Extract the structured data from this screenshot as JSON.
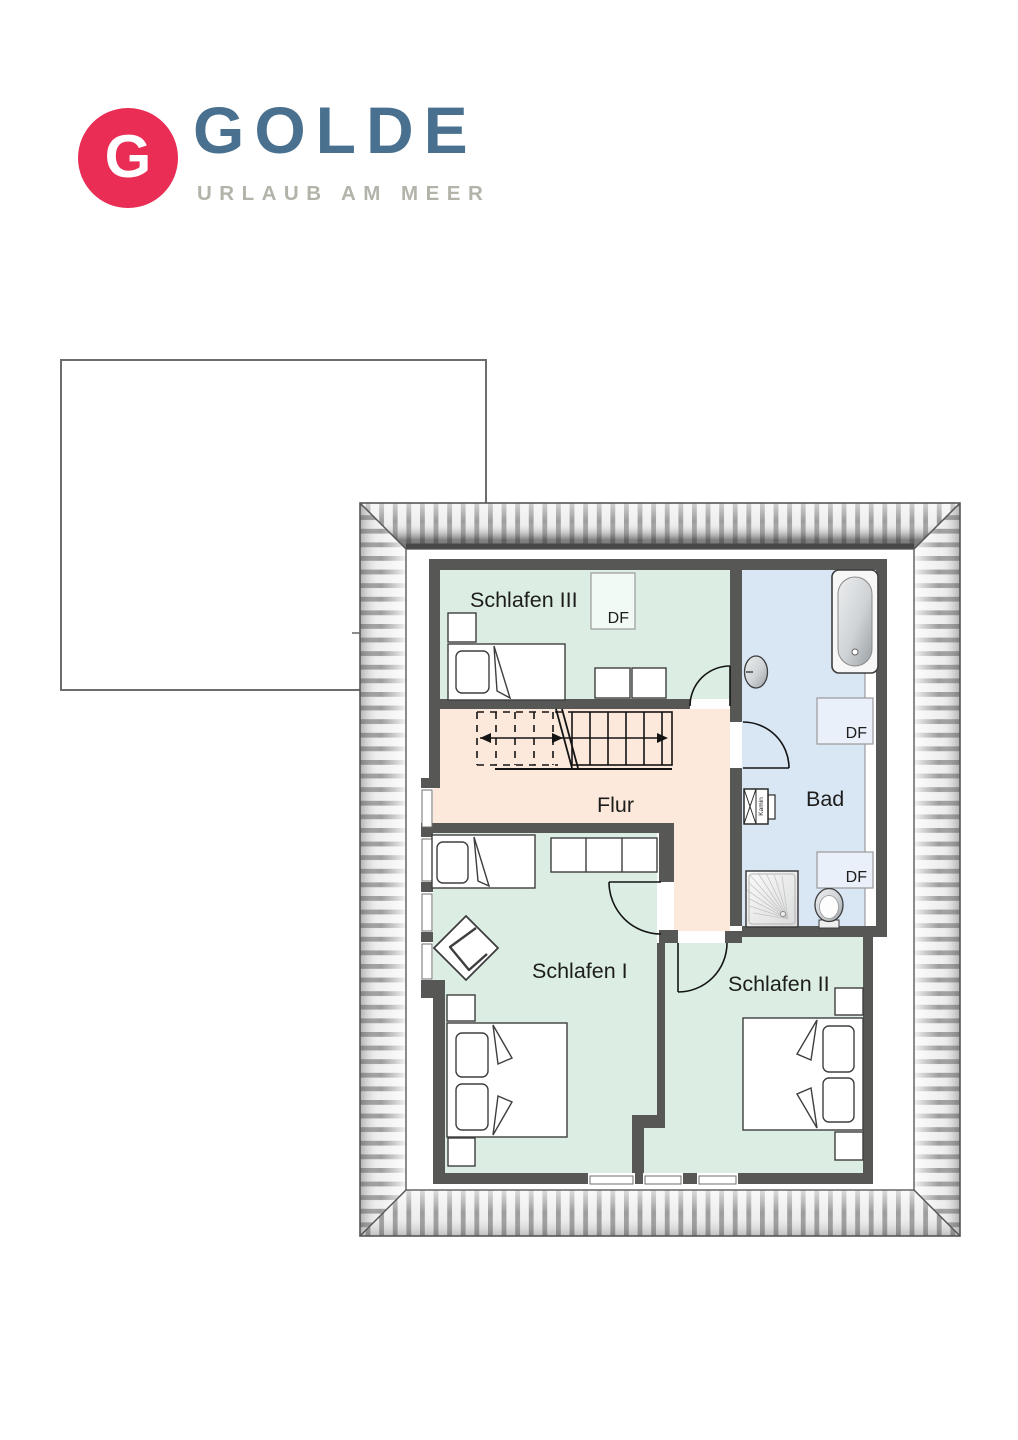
{
  "logo": {
    "letter": "G",
    "brand": "GOLDE",
    "tagline": "URLAUB AM MEER",
    "badge_color": "#e92d55",
    "brand_color": "#49718f",
    "tagline_color": "#b3b3a9"
  },
  "floorplan": {
    "wall_color": "#575756",
    "hatch_stripe_color": "#9c9c9c",
    "rooms": [
      {
        "name": "schlafen-3",
        "label": "Schlafen III",
        "floor_color": "#dceee3"
      },
      {
        "name": "bad",
        "label": "Bad",
        "floor_color": "#d9e6f4"
      },
      {
        "name": "flur",
        "label": "Flur",
        "floor_color": "#fce9dc"
      },
      {
        "name": "schlafen-1",
        "label": "Schlafen I",
        "floor_color": "#dceee3"
      },
      {
        "name": "schlafen-2",
        "label": "Schlafen II",
        "floor_color": "#dceee3"
      }
    ],
    "roof_windows": [
      {
        "label": "DF"
      },
      {
        "label": "DF"
      },
      {
        "label": "DF"
      }
    ],
    "chimney": {
      "label": "Kamin"
    }
  }
}
